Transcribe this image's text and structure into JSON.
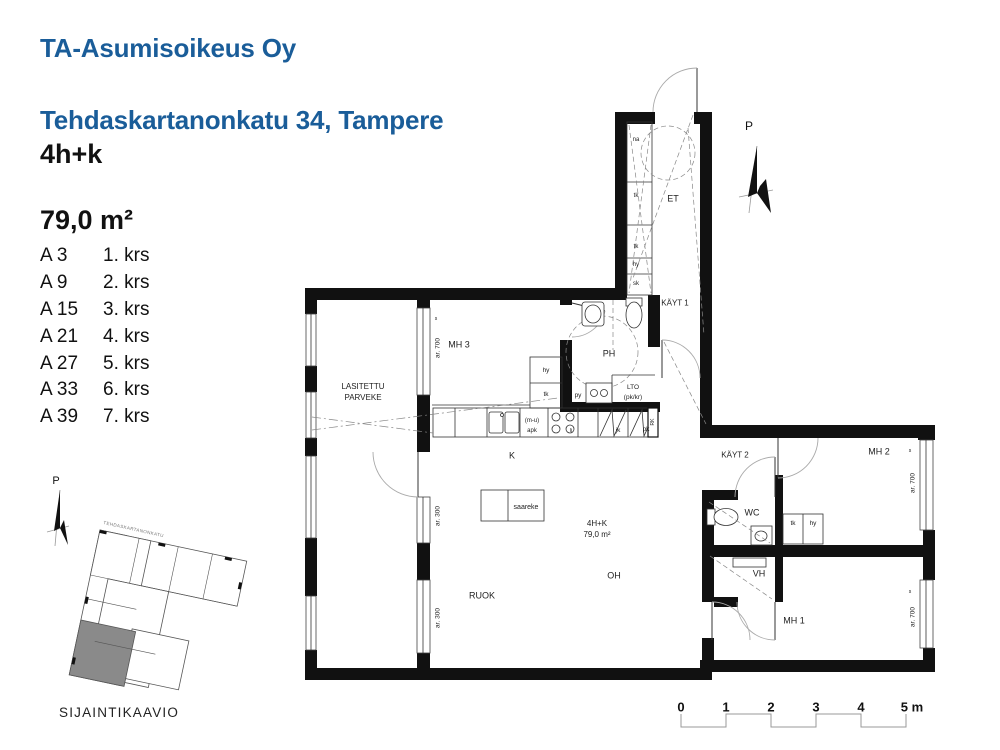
{
  "header": {
    "company": "TA-Asumisoikeus Oy",
    "address": "Tehdaskartanonkatu 34, Tampere"
  },
  "apartment": {
    "type": "4h+k",
    "area": "79,0 m²"
  },
  "units": [
    {
      "unit": "A 3",
      "floor": "1. krs"
    },
    {
      "unit": "A 9",
      "floor": "2. krs"
    },
    {
      "unit": "A 15",
      "floor": "3. krs"
    },
    {
      "unit": "A 21",
      "floor": "4. krs"
    },
    {
      "unit": "A 27",
      "floor": "5. krs"
    },
    {
      "unit": "A 33",
      "floor": "6. krs"
    },
    {
      "unit": "A 39",
      "floor": "7. krs"
    }
  ],
  "plan": {
    "rooms": {
      "balcony": "LASITETTU\nPARVEKE",
      "mh3": "MH 3",
      "ph": "PH",
      "et": "ET",
      "kayt1": "KÄYT 1",
      "lto": "LTO\n(pk/kr)",
      "kitchen": "K",
      "type_area": "4H+K\n79,0 m²",
      "oh": "OH",
      "ruok": "RUOK",
      "kayt2": "KÄYT 2",
      "wc": "WC",
      "vh": "VH",
      "mh1": "MH 1",
      "mh2": "MH 2"
    },
    "fixtures": {
      "saareke": "saareke",
      "na": "na",
      "tk": "tk",
      "hy": "hy",
      "sk": "sk",
      "py": "py",
      "apk": "(m-u)\napk",
      "li": "li",
      "jk": "jk",
      "pk": "pk",
      "rk": "RK"
    },
    "marks": {
      "ar700": "ar. 700",
      "ar300": "ar. 300",
      "s": "s",
      "north": "P"
    }
  },
  "site": {
    "caption": "SIJAINTIKAAVIO",
    "street": "TEHDASKARTANONKATU",
    "north": "P"
  },
  "scale_bar": {
    "ticks": [
      "0",
      "1",
      "2",
      "3",
      "4"
    ],
    "end_label": "5 m"
  },
  "colors": {
    "accent": "#1a5d99",
    "highlight_unit": "#8a8a8a"
  }
}
